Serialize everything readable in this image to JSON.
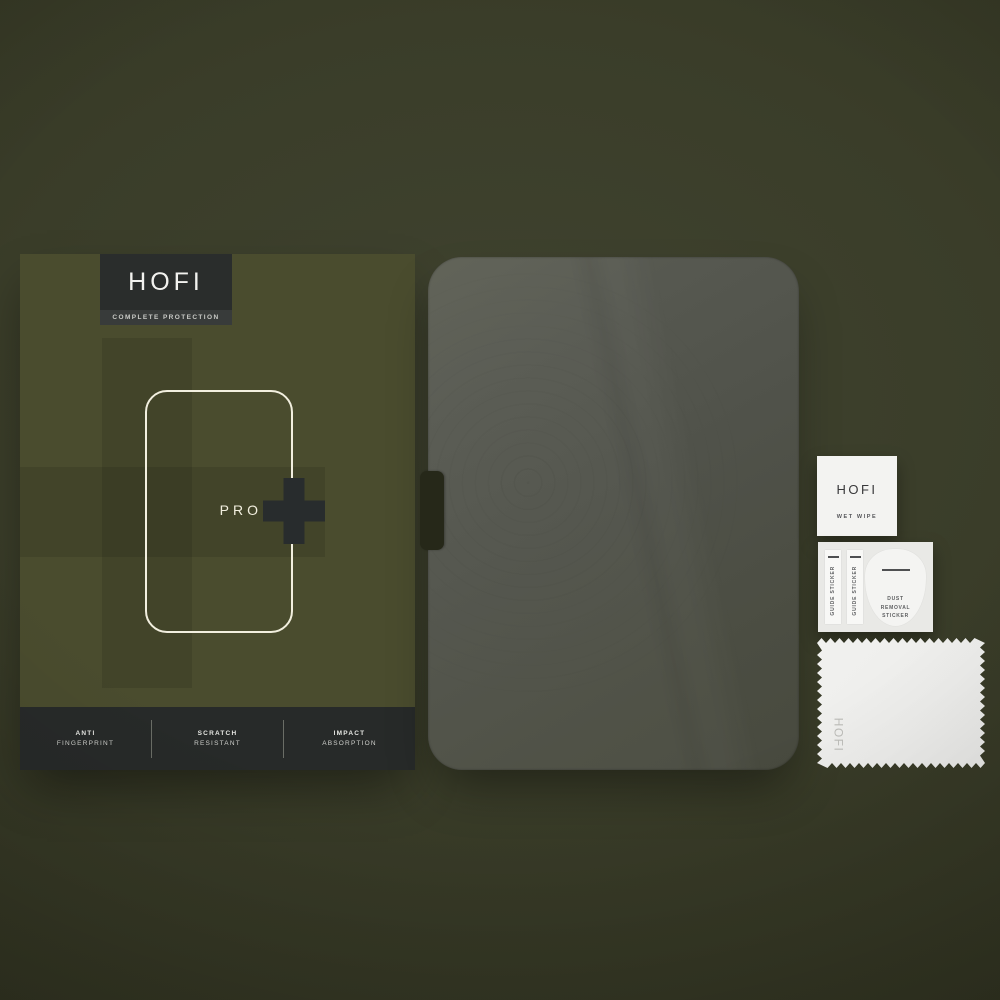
{
  "brand": {
    "name": "HOFI",
    "tagline": "COMPLETE PROTECTION"
  },
  "box": {
    "series_label": "PRO",
    "plus_icon": "plus",
    "features": [
      {
        "line1": "ANTI",
        "line2": "FINGERPRINT"
      },
      {
        "line1": "SCRATCH",
        "line2": "RESISTANT"
      },
      {
        "line1": "IMPACT",
        "line2": "ABSORPTION"
      }
    ]
  },
  "accessories": {
    "wet_wipe": {
      "brand": "HOFI",
      "label": "WET WIPE"
    },
    "guide_stickers": [
      {
        "label": "GUIDE STICKER"
      },
      {
        "label": "GUIDE STICKER"
      }
    ],
    "dust_removal": {
      "label": "DUST REMOVAL STICKER"
    },
    "cloth": {
      "brand": "HOFI"
    }
  },
  "colors": {
    "background_olive": "#3a3d29",
    "box_olive": "#4a4c2e",
    "badge_charcoal": "#2a2d2c",
    "feature_bar_charcoal": "#272a29",
    "outline_cream": "#f2efdf",
    "glass_tint": "#50524a",
    "accessory_white": "#f3f3f1"
  }
}
